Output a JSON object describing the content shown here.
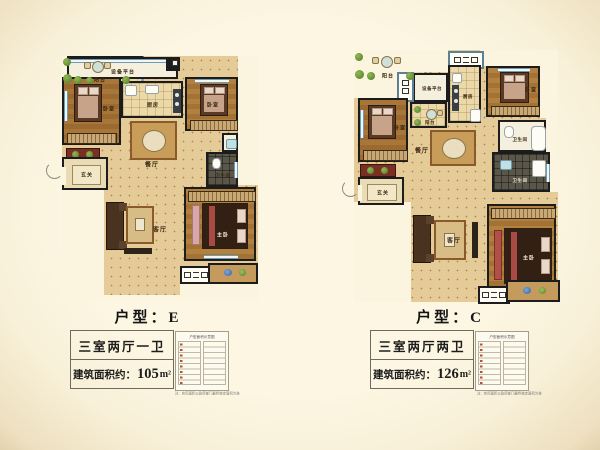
{
  "page": {
    "background": "#fbf4df",
    "vignette": "#e3d2ad"
  },
  "colors": {
    "wall": "#1c1c1c",
    "window_blue": "#7ba8b8",
    "wood": "#ab7b3d",
    "tile": "#e5cb98",
    "dark_tile": "#5a574a",
    "rug": "#c89d5a",
    "plant_green": "#5f8f3a"
  },
  "plans": [
    {
      "id": "E",
      "title": "户型：E",
      "spec": "三室两厅一卫",
      "area_label": "建筑面积约：",
      "area_value": "105",
      "area_unit": "m²",
      "rooms": {
        "platform": "设备平台",
        "kitchen": "厨房",
        "bedroom_left": "卧室",
        "bedroom_right": "卧室",
        "dining": "餐厅",
        "entry": "玄关",
        "bath": "卫生间",
        "living": "客厅",
        "master": "主卧",
        "balcony": "阳台"
      },
      "mini_table_title": "户型面积示意图",
      "disclaimer": "注：实际面积以政府部门最终核定面积为准"
    },
    {
      "id": "C",
      "title": "户型：C",
      "spec": "三室两厅两卫",
      "area_label": "建筑面积约：",
      "area_value": "126",
      "area_unit": "m²",
      "rooms": {
        "platform": "设备平台",
        "kitchen": "厨房",
        "balcony_top": "阳台",
        "bedroom_left": "卧室",
        "bedroom_right": "卧室",
        "dining": "餐厅",
        "entry": "玄关",
        "bath_top": "卫生间",
        "bath_bottom": "卫生间",
        "living": "客厅",
        "master": "主卧",
        "balcony": "阳台"
      },
      "mini_table_title": "户型面积示意图",
      "disclaimer": "注：实际面积以政府部门最终核定面积为准"
    }
  ]
}
